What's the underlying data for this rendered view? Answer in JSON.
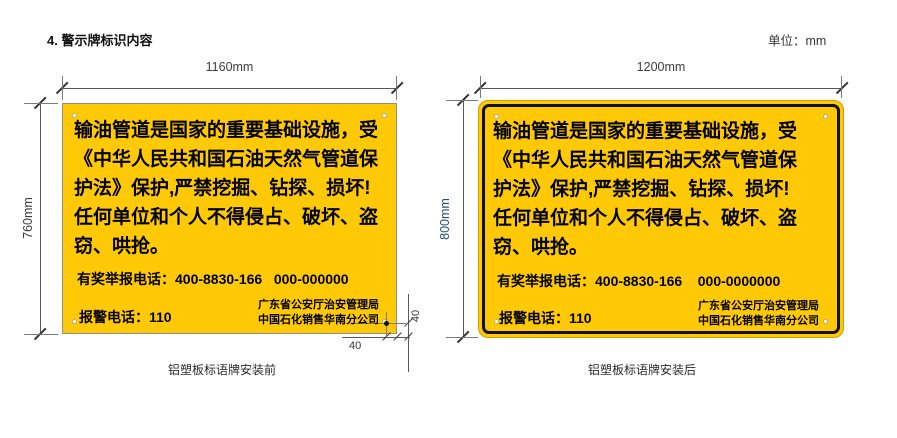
{
  "page": {
    "title": "4. 警示牌标识内容",
    "unit_label": "单位：mm"
  },
  "colors": {
    "board_yellow": "#FFC905",
    "frame_black": "#111111",
    "dim_line": "#5a5a5a",
    "height2_label_blue": "#1F4E79"
  },
  "signs": [
    {
      "width_label": "1160mm",
      "height_label": "760mm",
      "main_text": "输油管道是国家的重要基础设施，受\n《中华人民共和国石油天然气管道保\n护法》保护,严禁挖掘、钻探、损坏!\n任何单位和个人不得侵占、破坏、盗\n窃、哄抢。",
      "hotline": "有奖举报电话：400-8830-166   000-000000",
      "police": "报警电话：110",
      "agency": "广东省公安厅治安管理局\n中国石化销售华南分公司",
      "hole_offset_v": "40",
      "hole_offset_h": "40",
      "caption": "铝塑板标语牌安装前"
    },
    {
      "width_label": "1200mm",
      "height_label": "800mm",
      "main_text": "输油管道是国家的重要基础设施，受\n《中华人民共和国石油天然气管道保\n护法》保护,严禁挖掘、钻探、损坏!\n任何单位和个人不得侵占、破坏、盗\n窃、哄抢。",
      "hotline": "有奖举报电话：400-8830-166    000-0000000",
      "police": "报警电话：110",
      "agency": "广东省公安厅治安管理局\n中国石化销售华南分公司",
      "caption": "铝塑板标语牌安装后"
    }
  ]
}
